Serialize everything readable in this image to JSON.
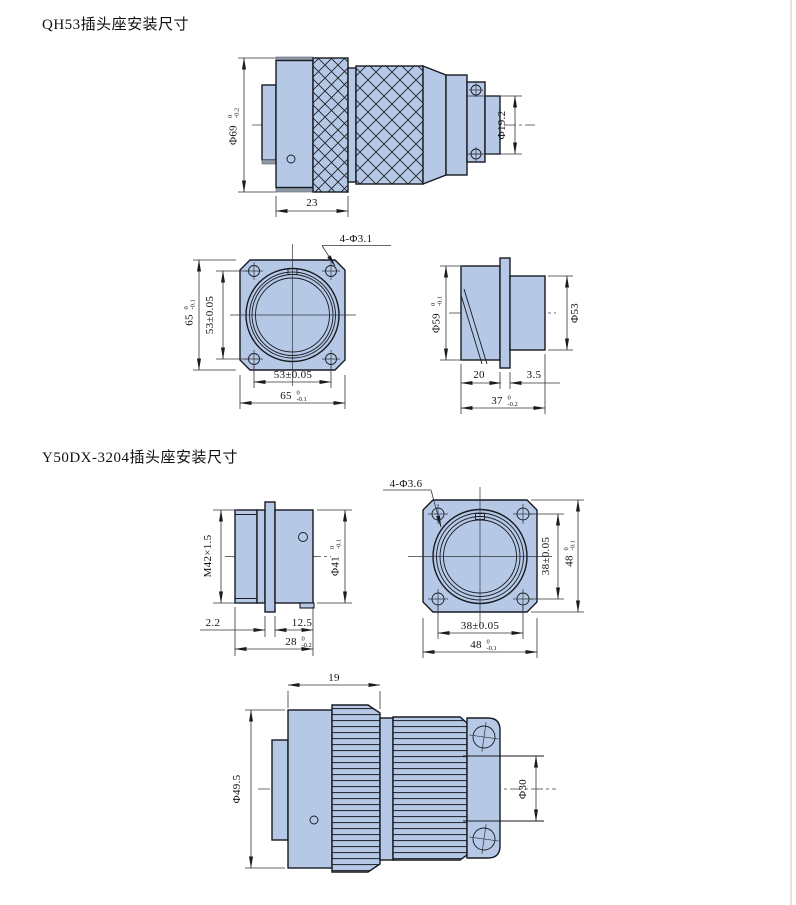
{
  "doc_type": "connector-mounting-dimension-drawing",
  "colors": {
    "part_fill": "#b5c8e6",
    "outline": "#181a20",
    "page_bg": "#ffffff",
    "page_edge": "#e2e2e2",
    "text": "#111111"
  },
  "sections": [
    {
      "title": "QH53插头座安装尺寸",
      "side": {
        "phi69": {
          "main": "Φ69",
          "up": "0",
          "dn": "-0.2"
        },
        "phi19": "Φ19.2",
        "len23": "23"
      },
      "front": {
        "holes": "4-Φ3.1",
        "v65": {
          "main": "65",
          "up": "0",
          "dn": "-0.1"
        },
        "v53": "53±0.05",
        "h53": "53±0.05",
        "h65": {
          "main": "65",
          "up": "0",
          "dn": "-0.1"
        }
      },
      "side2": {
        "phi59": {
          "main": "Φ59",
          "up": "0",
          "dn": "-0.1"
        },
        "phi53": "Φ53",
        "len20": "20",
        "len35": "3.5",
        "len37": {
          "main": "37",
          "up": "0",
          "dn": "-0.2"
        }
      }
    },
    {
      "title": "Y50DX-3204插头座安装尺寸",
      "side": {
        "m42": "M42×1.5",
        "phi41": {
          "main": "Φ41",
          "up": "0",
          "dn": "-0.1"
        },
        "len22": "2.2",
        "len125": "12.5",
        "len28": {
          "main": "28",
          "up": "0",
          "dn": "-0.2"
        }
      },
      "front": {
        "holes": "4-Φ3.6",
        "v38": "38±0.05",
        "v48": {
          "main": "48",
          "up": "0",
          "dn": "-0.1"
        },
        "h38": "38±0.05",
        "h48": {
          "main": "48",
          "up": "0",
          "dn": "-0.1"
        }
      },
      "bottom": {
        "len19": "19",
        "phi495": "Φ49.5",
        "phi30": "Φ30"
      }
    }
  ]
}
